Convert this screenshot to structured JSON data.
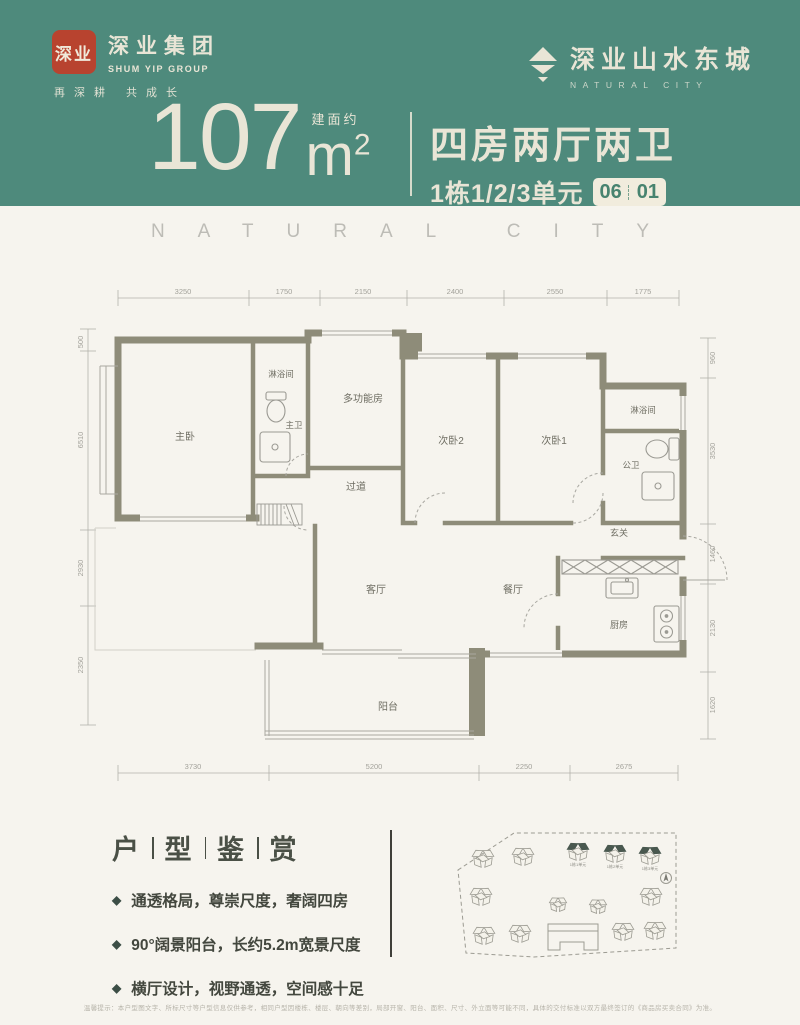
{
  "colors": {
    "teal": "#4e8a7c",
    "cream": "#e9e5d6",
    "seal_red": "#b8432f",
    "page_bg": "#f6f4ee",
    "wall": "#8e8c79",
    "accent_dark": "#43524b"
  },
  "header": {
    "logo": {
      "seal": "深业",
      "company_cn": "深业集团",
      "company_en": "SHUM YIP GROUP",
      "slogan": "再深耕 共成长"
    },
    "brand": {
      "name_cn": "深业山水东城",
      "name_en": "NATURAL CITY"
    },
    "headline": {
      "area_label": "建面约",
      "area_number": "107",
      "area_unit": "m",
      "area_sup": "2",
      "layout": "四房两厅两卫",
      "units": "1栋1/2/3单元",
      "badge_left": "06",
      "badge_right": "01"
    }
  },
  "watermark": "NATURAL CITY",
  "floorplan": {
    "dims_top": [
      "3250",
      "1750",
      "2150",
      "2400",
      "2550",
      "1775"
    ],
    "dims_bottom": [
      "3730",
      "5200",
      "2250",
      "2675"
    ],
    "dims_left": [
      "500",
      "6510",
      "2930",
      "2350"
    ],
    "dims_right": [
      "960",
      "3530",
      "1460",
      "2130",
      "1620"
    ],
    "rooms": {
      "master": "主卧",
      "shower1": "淋浴间",
      "master_bath": "主卫",
      "multi": "多功能房",
      "bed2": "次卧2",
      "bed1": "次卧1",
      "shower2": "淋浴间",
      "guest_bath": "公卫",
      "corridor": "过道",
      "foyer": "玄关",
      "living": "客厅",
      "dining": "餐厅",
      "kitchen": "厨房",
      "balcony": "阳台"
    }
  },
  "features": {
    "title_chars": [
      "户",
      "型",
      "鉴",
      "赏"
    ],
    "items": [
      "通透格局，尊崇尺度，奢阔四房",
      "90°阔景阳台，长约5.2m宽景尺度",
      "横厅设计，视野通透，空间感十足"
    ]
  },
  "siteplan": {
    "labels": [
      "1栋1单元",
      "1栋2单元",
      "1栋3单元"
    ]
  },
  "disclaimer": "温馨提示：本户型图文字、所标尺寸等户型信息仅供参考，相同户型因楼栋、楼层、朝向等差别，局部开窗、阳台、面积、尺寸、外立面等可能不同，具体的交付标准以双方最终签订的《商品房买卖合同》为准。"
}
